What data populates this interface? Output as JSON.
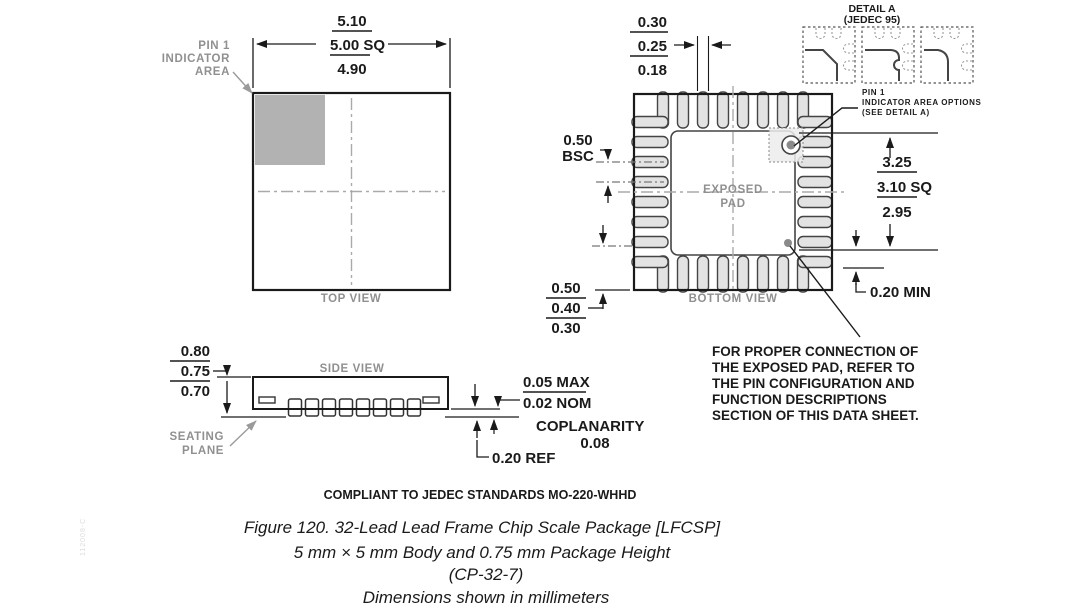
{
  "labels": {
    "top_view": "TOP VIEW",
    "bottom_view": "BOTTOM VIEW",
    "side_view": "SIDE VIEW",
    "exposed_pad": [
      "EXPOSED",
      "PAD"
    ],
    "pin1_indicator": [
      "PIN 1",
      "INDICATOR",
      "AREA"
    ],
    "pin1_options": [
      "PIN 1",
      "INDICATOR AREA OPTIONS",
      "(SEE DETAIL A)"
    ],
    "detail_a": [
      "DETAIL A",
      "(JEDEC 95)"
    ],
    "seating_plane": [
      "SEATING",
      "PLANE"
    ]
  },
  "dims": {
    "body": [
      "5.10",
      "5.00 SQ",
      "4.90"
    ],
    "lead_width": [
      "0.30",
      "0.25",
      "0.18"
    ],
    "pitch": [
      "0.50",
      "BSC"
    ],
    "lead_length": [
      "0.50",
      "0.40",
      "0.30"
    ],
    "pad": [
      "3.25",
      "3.10 SQ",
      "2.95"
    ],
    "pad_keepout": "0.20 MIN",
    "height": [
      "0.80",
      "0.75",
      "0.70"
    ],
    "standoff": [
      "0.05 MAX",
      "0.02 NOM"
    ],
    "coplanarity": [
      "COPLANARITY",
      "0.08"
    ],
    "lead_thickness": "0.20 REF"
  },
  "note_lines": [
    "FOR PROPER CONNECTION OF",
    "THE EXPOSED PAD, REFER TO",
    "THE PIN CONFIGURATION AND",
    "FUNCTION DESCRIPTIONS",
    "SECTION OF THIS DATA SHEET."
  ],
  "captions": {
    "compliance": "COMPLIANT TO JEDEC STANDARDS MO-220-WHHD",
    "figure_line1": "Figure 120. 32-Lead Lead Frame Chip Scale Package [LFCSP]",
    "figure_line2": "5 mm × 5 mm Body and 0.75 mm Package Height",
    "figure_line3": "(CP-32-7)",
    "figure_line4": "Dimensions shown in millimeters"
  },
  "side_code": "112008-C",
  "colors": {
    "line": "#1a1a1a",
    "gray_text": "#909090",
    "pin_fill": "#e3e3e3",
    "indicator_fill": "#b2b2b2"
  }
}
